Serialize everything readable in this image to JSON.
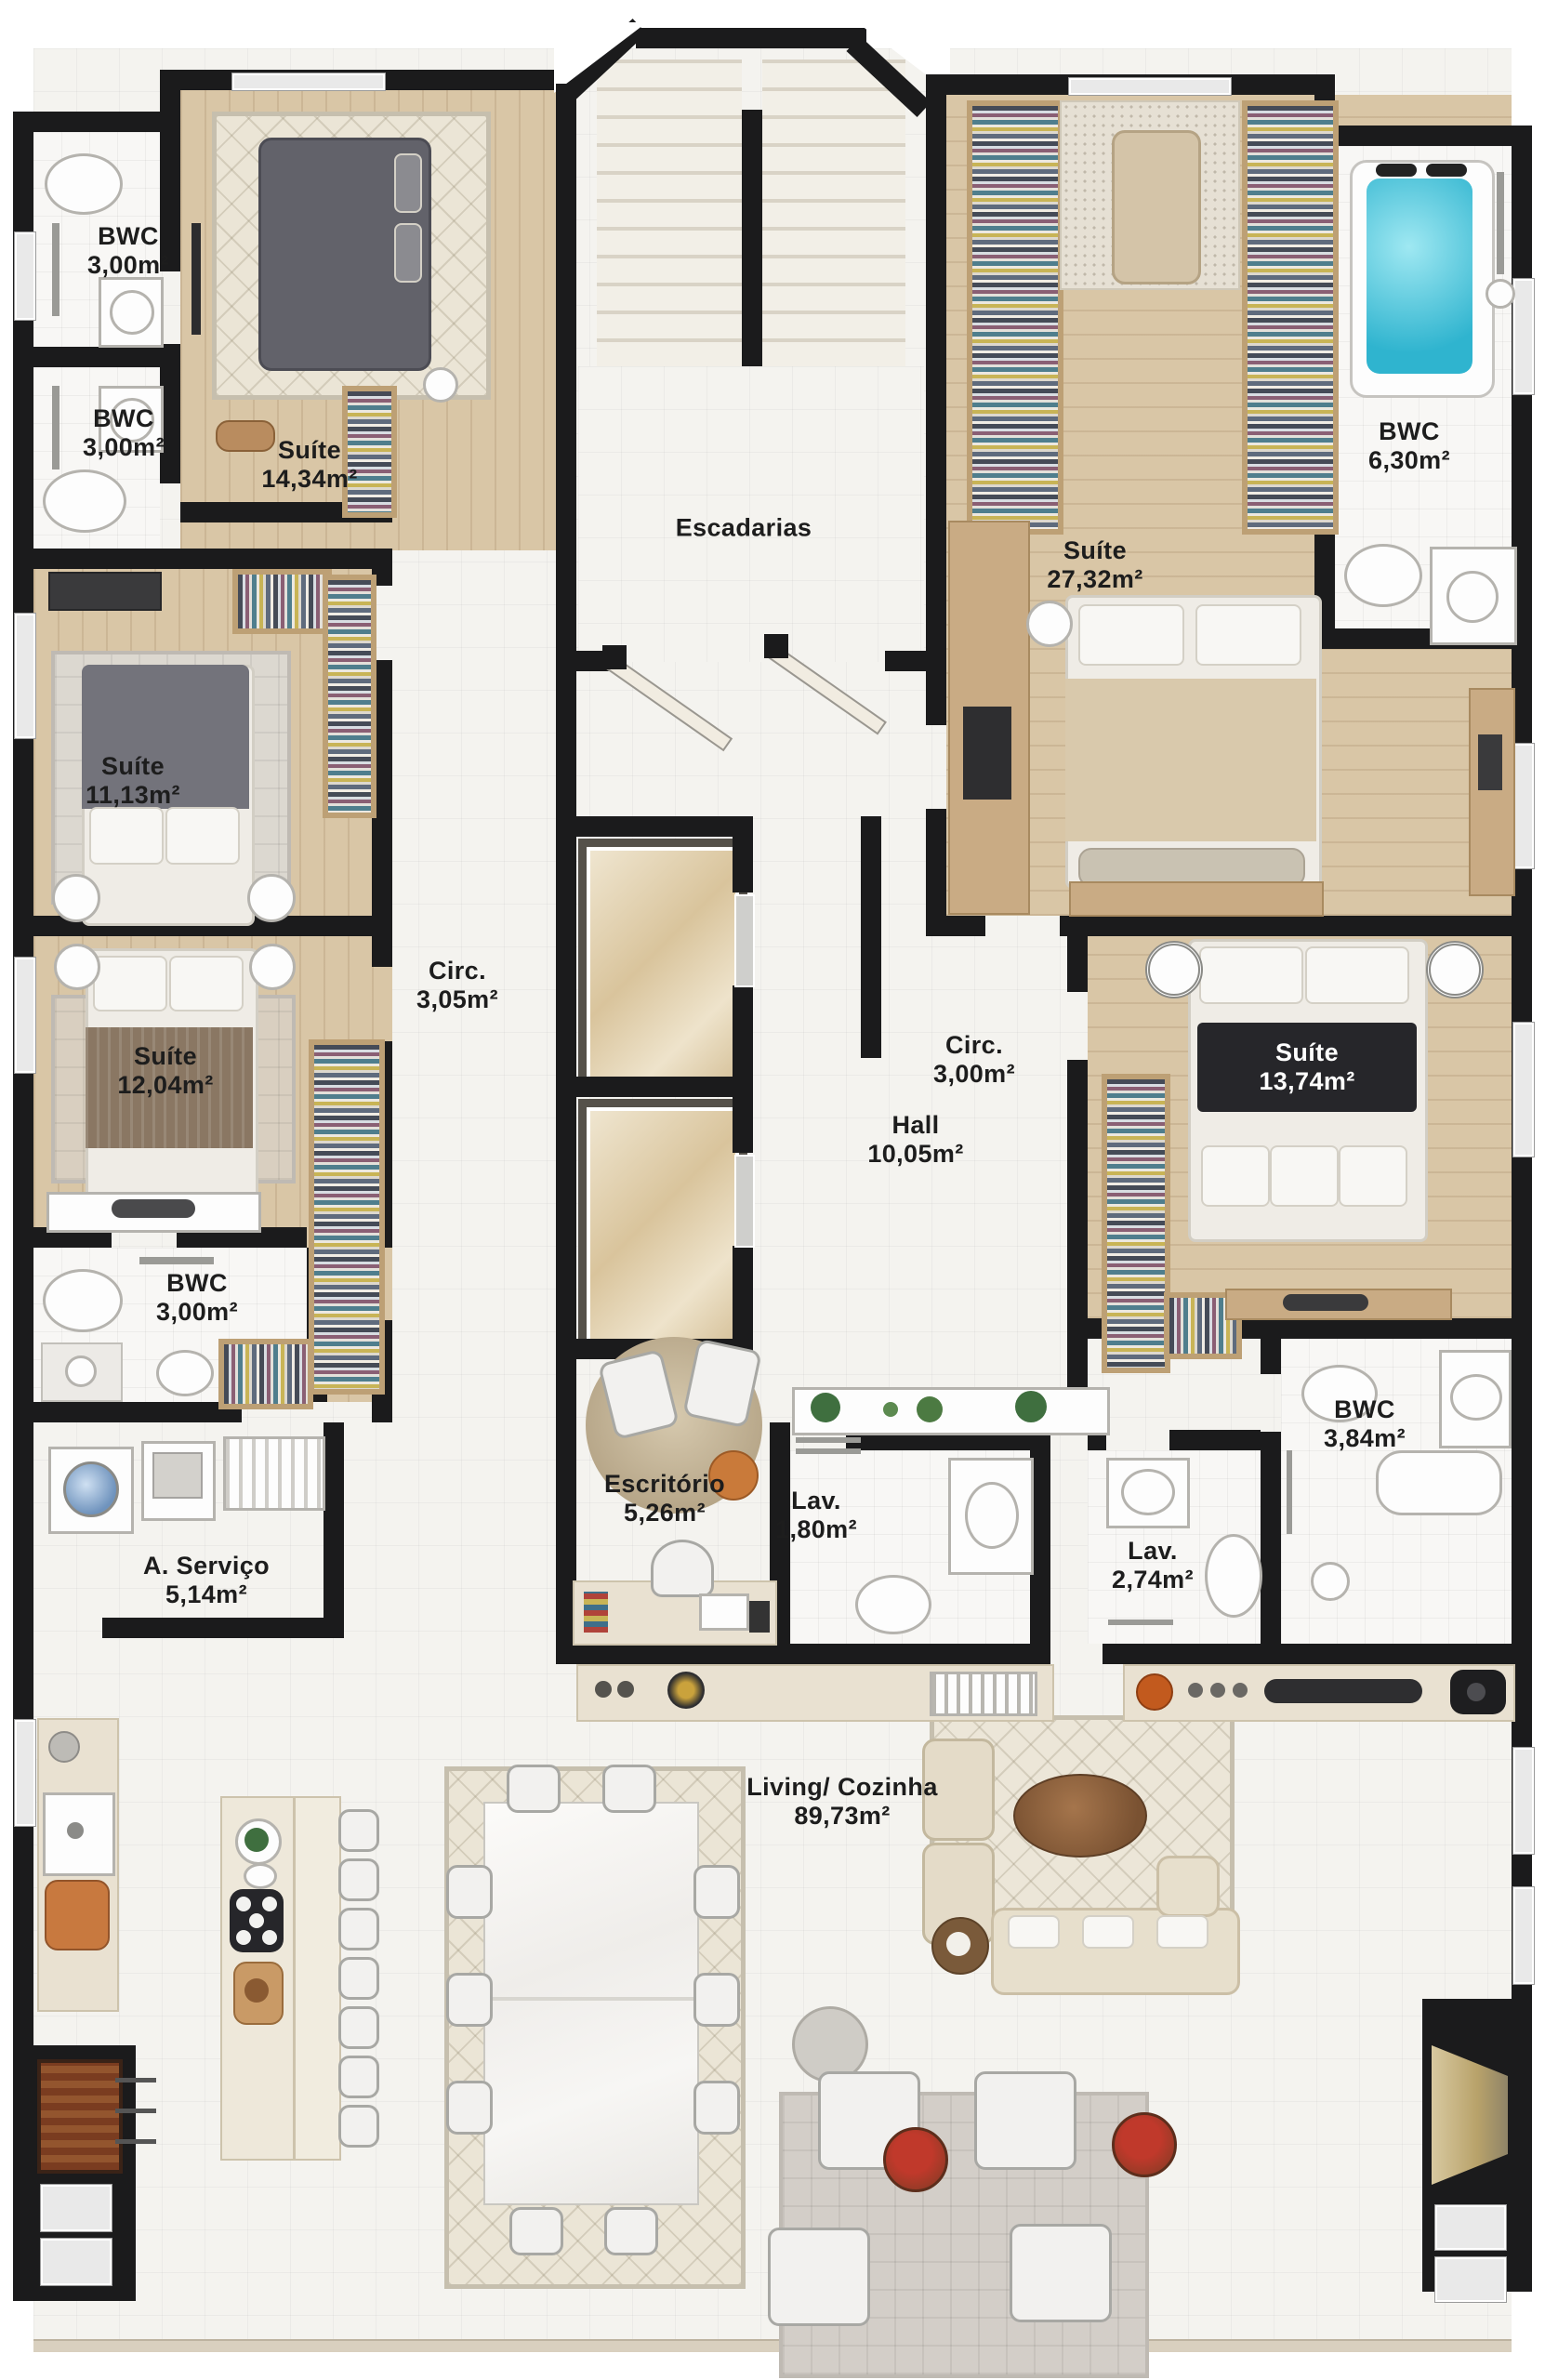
{
  "plan": {
    "type": "apartment-floor-plan",
    "language": "pt-BR"
  },
  "rooms": [
    {
      "id": "bwc-top-1",
      "name": "BWC",
      "area": "3,00m²"
    },
    {
      "id": "bwc-top-2",
      "name": "BWC",
      "area": "3,00m²"
    },
    {
      "id": "suite-14",
      "name": "Suíte",
      "area": "14,34m²"
    },
    {
      "id": "escadarias",
      "name": "Escadarias",
      "area": ""
    },
    {
      "id": "suite-27",
      "name": "Suíte",
      "area": "27,32m²"
    },
    {
      "id": "bwc-630",
      "name": "BWC",
      "area": "6,30m²"
    },
    {
      "id": "suite-11",
      "name": "Suíte",
      "area": "11,13m²"
    },
    {
      "id": "circ-305",
      "name": "Circ.",
      "area": "3,05m²"
    },
    {
      "id": "suite-12",
      "name": "Suíte",
      "area": "12,04m²"
    },
    {
      "id": "circ-300",
      "name": "Circ.",
      "area": "3,00m²"
    },
    {
      "id": "hall",
      "name": "Hall",
      "area": "10,05m²"
    },
    {
      "id": "suite-1374",
      "name": "Suíte",
      "area": "13,74m²"
    },
    {
      "id": "bwc-3",
      "name": "BWC",
      "area": "3,00m²"
    },
    {
      "id": "bwc-384",
      "name": "BWC",
      "area": "3,84m²"
    },
    {
      "id": "a-servico",
      "name": "A. Serviço",
      "area": "5,14m²"
    },
    {
      "id": "escritorio",
      "name": "Escritório",
      "area": "5,26m²"
    },
    {
      "id": "lav-180",
      "name": "Lav.",
      "area": "1,80m²"
    },
    {
      "id": "lav-274",
      "name": "Lav.",
      "area": "2,74m²"
    },
    {
      "id": "living-cozinha",
      "name": "Living/ Cozinha",
      "area": "89,73m²"
    }
  ],
  "colors": {
    "wall": "#1b1b1c",
    "wood_floor": "#d9c6a6",
    "tile_floor": "#f4f3ef",
    "label_text": "#1d1d1d",
    "suite13_plaque": "#26262a",
    "jacuzzi_water": "#3fc6de",
    "closet_wood": "#bda075",
    "sofa_beige": "#e7dfcc",
    "flower_pot_red": "#b03030"
  }
}
